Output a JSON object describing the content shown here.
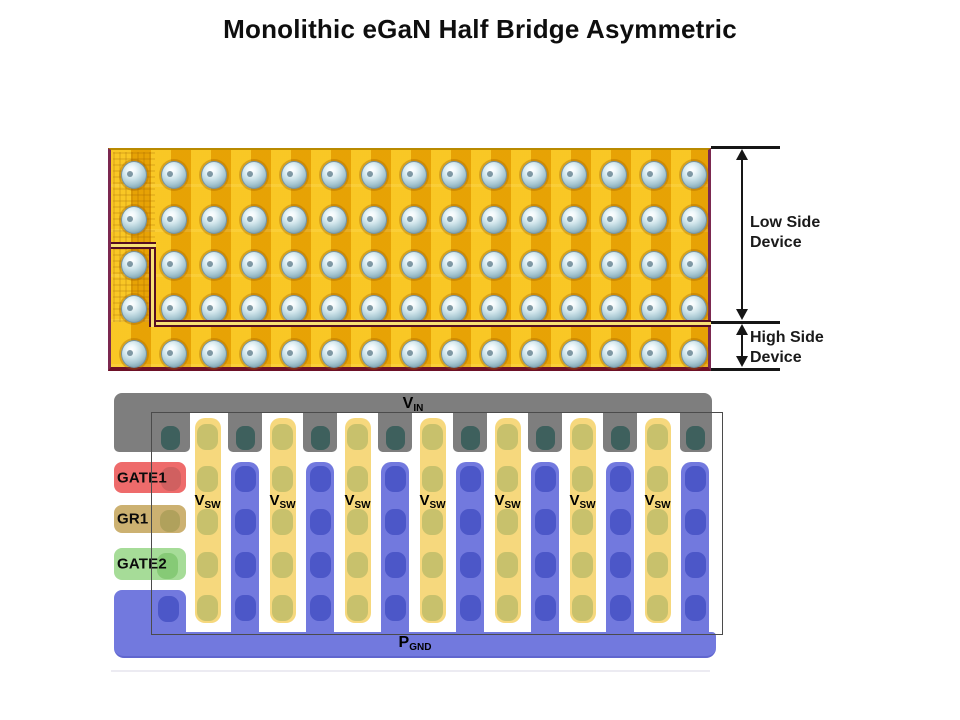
{
  "title": "Monolithic eGaN Half Bridge Asymmetric",
  "die_photo": {
    "annotations": {
      "low_side": {
        "line1": "Low Side",
        "line2": "Device"
      },
      "high_side": {
        "line1": "High Side",
        "line2": "Device"
      }
    },
    "ball_grid": {
      "columns": 15,
      "rows": 5
    },
    "colors": {
      "gold_light": "#f6c110",
      "gold_dark": "#eca303",
      "border_maroon": "#7b2850",
      "street_dark": "#550e22",
      "street_light": "#f7e175"
    }
  },
  "layout_diagram": {
    "vin": {
      "main": "V",
      "sub": "IN"
    },
    "pgnd": {
      "main": "P",
      "sub": "GND"
    },
    "vsw_labels": [
      {
        "main": "V",
        "sub": "SW"
      },
      {
        "main": "V",
        "sub": "SW"
      },
      {
        "main": "V",
        "sub": "SW"
      },
      {
        "main": "V",
        "sub": "SW"
      },
      {
        "main": "V",
        "sub": "SW"
      },
      {
        "main": "V",
        "sub": "SW"
      },
      {
        "main": "V",
        "sub": "SW"
      }
    ],
    "gate_labels": [
      {
        "label": "GATE1",
        "color": "#ee6b6b",
        "pad_color": "#d06060"
      },
      {
        "label": "GR1",
        "color": "#ccb171",
        "pad_color": "#b0a15c"
      },
      {
        "label": "GATE2",
        "color": "#a6dc98",
        "pad_color": "#86ca76"
      }
    ],
    "counts": {
      "vsw_bars": 7,
      "gnd_fingers": 7,
      "vin_pads": 8
    },
    "colors": {
      "vin_bar": "#7e7e7e",
      "vin_pad": "#3e605d",
      "vsw_bar": "#f6d87d",
      "vsw_pad": "#c8c16c",
      "gnd_bar": "#7279de",
      "gnd_pad": "#4c57c8"
    }
  }
}
